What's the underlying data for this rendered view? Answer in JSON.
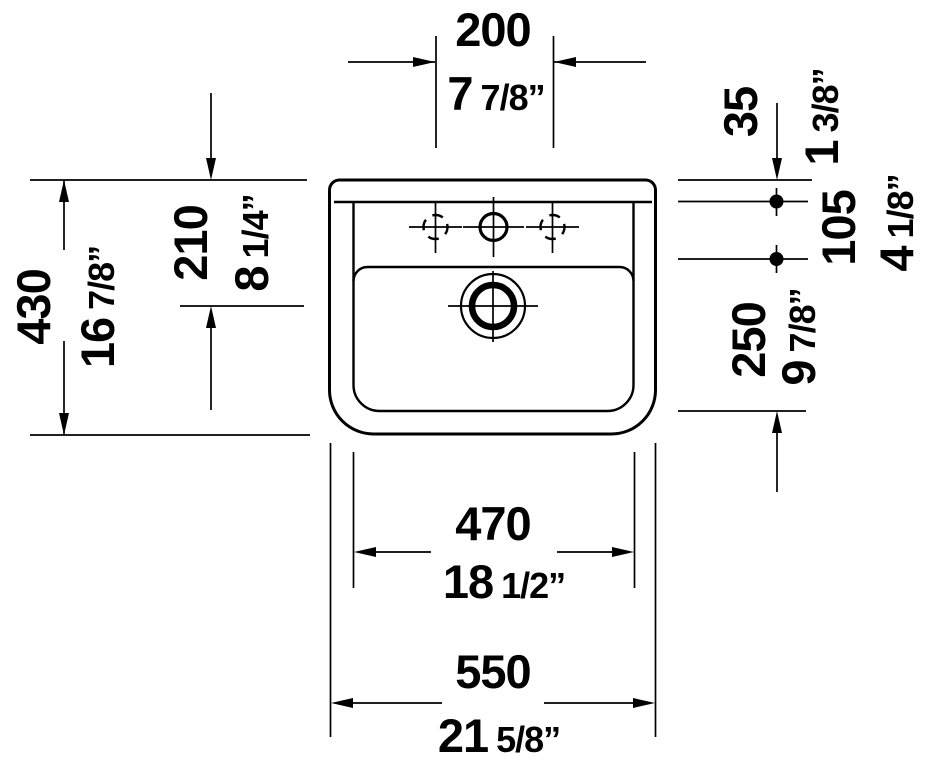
{
  "drawing": {
    "subject": "wall-mounted washbasin, front view technical drawing",
    "line_color": "#000000",
    "background_color": "#ffffff"
  },
  "dimensions": {
    "tap_spacing": {
      "mm": "200",
      "inch_whole": "7",
      "inch_frac": "7/8”"
    },
    "top_offset": {
      "mm": "35",
      "inch_whole": "1",
      "inch_frac": "3/8”"
    },
    "fixing_holes": {
      "mm": "105",
      "inch_whole": "4",
      "inch_frac": "1/8”"
    },
    "fixing_to_bottom": {
      "mm": "250",
      "inch_whole": "9",
      "inch_frac": "7/8”"
    },
    "height": {
      "mm": "430",
      "inch_whole": "16",
      "inch_frac": "7/8”"
    },
    "rim_to_drain": {
      "mm": "210",
      "inch_whole": "8",
      "inch_frac": "1/4”"
    },
    "bowl_width": {
      "mm": "470",
      "inch_whole": "18",
      "inch_frac": "1/2”"
    },
    "overall_width": {
      "mm": "550",
      "inch_whole": "21",
      "inch_frac": "5/8”"
    }
  }
}
